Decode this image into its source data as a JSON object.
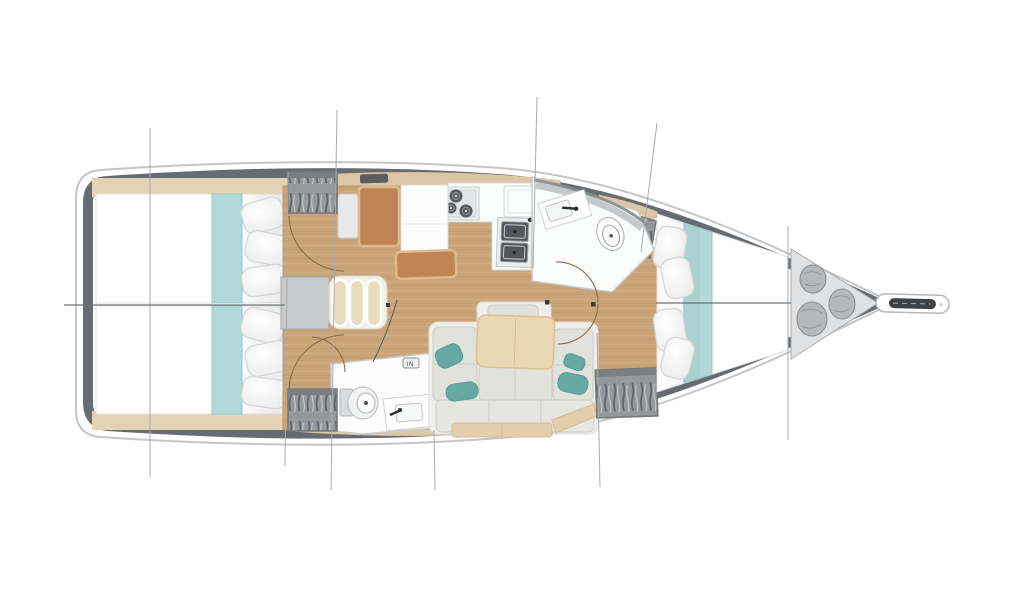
{
  "meta": {
    "type": "sailing-yacht interior floor plan, top-down line rendering",
    "orientation": "bow to the right, stern to the left"
  },
  "palette": {
    "background": "#ffffff",
    "hull_band": "#686c70",
    "hull_outline": "#c3c6c8",
    "wood_floor": "#c9a478",
    "deck_trim": "#dbc7a6",
    "bed_runner_teal": "#b0d9d7",
    "accent_pillow_teal": "#67aaa4",
    "nav_wood_brown": "#c08354",
    "sofa_cushion": "#e2e2dd",
    "table_wood": "#ead7b4",
    "locker_gray": "#96999c",
    "fixture_white": "#fbfcfc",
    "section_line": "#a8abad"
  },
  "rooms": [
    {
      "name": "aft-cabin-port",
      "furniture": [
        "double berth",
        "teal runner",
        "pillows",
        "hanging locker"
      ]
    },
    {
      "name": "aft-cabin-starboard",
      "furniture": [
        "double berth",
        "teal runner",
        "pillows",
        "hanging locker"
      ]
    },
    {
      "name": "companionway",
      "furniture": [
        "landing",
        "3 curved steps"
      ]
    },
    {
      "name": "nav-station",
      "furniture": [
        "nav seat",
        "chart table",
        "bench"
      ]
    },
    {
      "name": "galley",
      "furniture": [
        "3-burner stove",
        "double sink",
        "fridge",
        "counters"
      ]
    },
    {
      "name": "aft-head",
      "furniture": [
        "toilet",
        "washbasin",
        "mixer tap"
      ]
    },
    {
      "name": "salon",
      "furniture": [
        "L-shaped sofa",
        "dining table",
        "teal accent pillows",
        "hanging locker"
      ]
    },
    {
      "name": "forward-head",
      "furniture": [
        "washbasin",
        "toilet"
      ]
    },
    {
      "name": "forward-cabin",
      "furniture": [
        "V-berth",
        "teal runner",
        "pillows",
        "hanging lockers"
      ]
    },
    {
      "name": "bow-locker",
      "furniture": [
        "fender bag",
        "fender bag",
        "fender bag"
      ]
    },
    {
      "name": "bowsprit",
      "furniture": [
        "anchor roller"
      ]
    }
  ],
  "counts": {
    "stove_burners": 3,
    "galley_sinks": 2,
    "companionway_steps": 3,
    "fender_bags": 3,
    "teal_accent_pillows": 4,
    "hanging_lockers": 4,
    "section_lines": 8,
    "centerline_segments": 2
  },
  "annotations": {
    "in_chip": "IN"
  }
}
